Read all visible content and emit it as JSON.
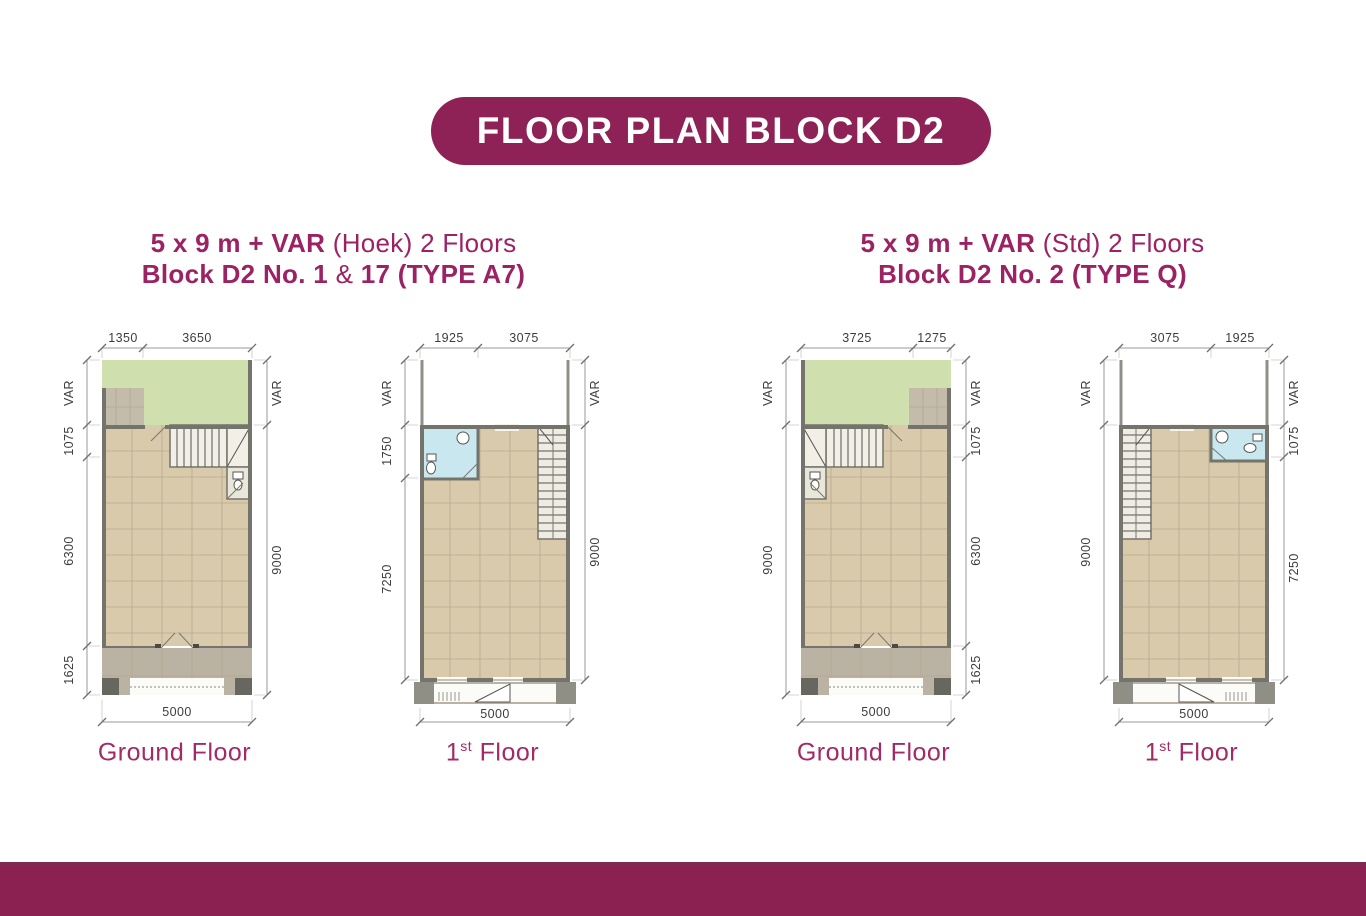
{
  "header": {
    "title": "FLOOR PLAN BLOCK D2"
  },
  "colors": {
    "brand_maroon": "#8E2156",
    "accent_text": "#9B2263",
    "footer_bar": "#8A2150",
    "floor_fill": "#D9CAAC",
    "garden_green": "#CFE0AE",
    "bathroom_blue": "#C9E7EE"
  },
  "units": [
    {
      "title": {
        "bold": "5 x 9 m + VAR",
        "rest": " (Hoek) 2 Floors"
      },
      "subtitle": {
        "bold1": "Block D2 No. 1",
        "mid": " & ",
        "bold2": "17 (TYPE A7)"
      }
    },
    {
      "title": {
        "bold": "5 x 9 m + VAR",
        "rest": " (Std) 2 Floors"
      },
      "subtitle": {
        "bold1": "Block D2 No. 2 (TYPE Q)",
        "mid": "",
        "bold2": ""
      }
    }
  ],
  "plans": [
    {
      "name": "Type A7 Ground Floor",
      "label": {
        "prefix": "Ground Floor",
        "sup": "",
        "suffix": ""
      },
      "dims_top": [
        "1350",
        "3650"
      ],
      "dims_left": [
        "VAR",
        "1075",
        "6300",
        "1625"
      ],
      "dims_right": [
        "VAR",
        "9000"
      ],
      "dim_bottom": "5000"
    },
    {
      "name": "Type A7 1st Floor",
      "label": {
        "prefix": "1",
        "sup": "st",
        "suffix": " Floor"
      },
      "dims_top": [
        "1925",
        "3075"
      ],
      "dims_left": [
        "VAR",
        "1750",
        "7250"
      ],
      "dims_right": [
        "VAR",
        "9000"
      ],
      "dim_bottom": "5000"
    },
    {
      "name": "Type Q Ground Floor",
      "label": {
        "prefix": "Ground Floor",
        "sup": "",
        "suffix": ""
      },
      "dims_top": [
        "3725",
        "1275"
      ],
      "dims_left": [
        "VAR",
        "9000"
      ],
      "dims_right": [
        "VAR",
        "1075",
        "6300",
        "1625"
      ],
      "dim_bottom": "5000"
    },
    {
      "name": "Type Q 1st Floor",
      "label": {
        "prefix": "1",
        "sup": "st",
        "suffix": " Floor"
      },
      "dims_top": [
        "3075",
        "1925"
      ],
      "dims_left": [
        "VAR",
        "9000"
      ],
      "dims_right": [
        "VAR",
        "1075",
        "7250"
      ],
      "dim_bottom": "5000"
    }
  ]
}
